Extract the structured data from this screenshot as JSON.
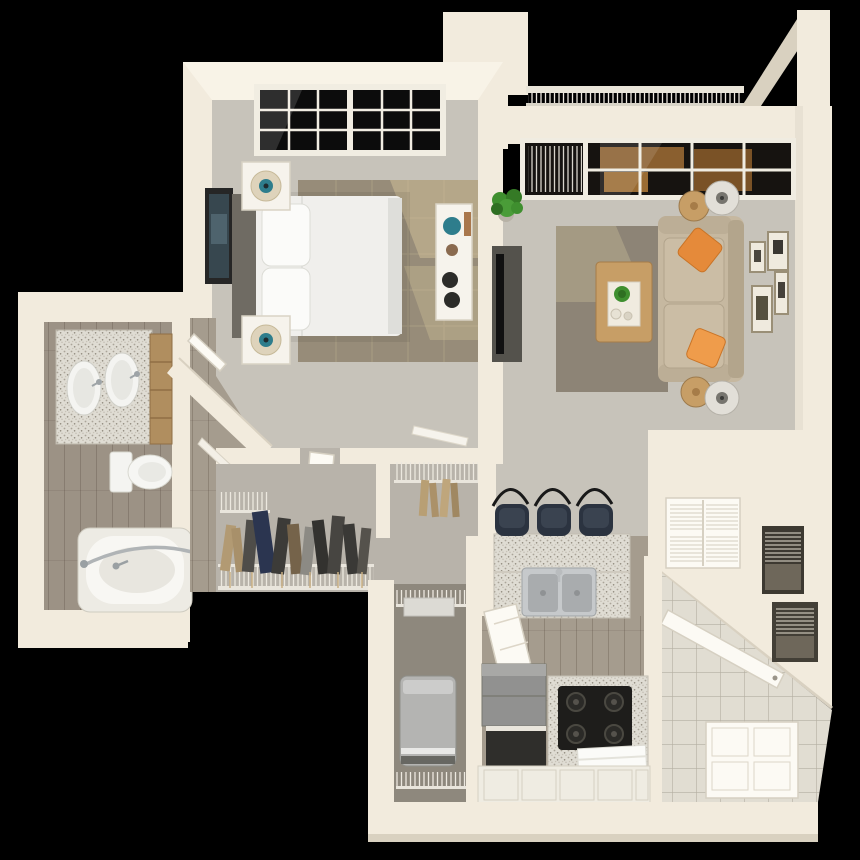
{
  "meta": {
    "type": "3d-floor-plan-render",
    "description": "Top-down 3D rendering of a one-bedroom, one-bathroom apartment floor plan with balcony, on a black background",
    "view": "isometric top-down dollhouse view",
    "visible_text": []
  },
  "palette": {
    "bg": "#000000",
    "wall": "#f2ebdd",
    "wallShade": "#d9d1c0",
    "wallBright": "#f8f3e7",
    "carpet": "#c7c3ba",
    "carpetDark": "#b8b3aa",
    "wood": "#a59c8e",
    "woodBath": "#9c9285",
    "tile": "#e1ddd2",
    "granite": "#dfdcd3",
    "rugBed": "#978c79",
    "rugLiving": "#8d8476",
    "sofa": "#c6b8a0",
    "orange": "#e58a3a",
    "teal": "#2e7d8c",
    "bedWhite": "#f0efec",
    "headboard": "#6f6b63",
    "tv": "#54524c",
    "appliance": "#b4b4b2",
    "cooktop": "#1e1d1b",
    "stool": "#2b3340",
    "plant": "#3f8f2f",
    "woodFurn": "#c79e66",
    "glass": "#0c0c0c"
  },
  "rooms": {
    "balcony": {
      "label": "Balcony with railing",
      "features": [
        "baluster railing",
        "patio furniture visible through windows"
      ]
    },
    "bedroom": {
      "label": "Bedroom",
      "features": [
        "double window",
        "queen bed with white bedding",
        "gray headboard",
        "two white nightstands with lamps",
        "taupe area rug",
        "white dresser with teal vase",
        "framed wall art",
        "gray carpet"
      ]
    },
    "living": {
      "label": "Living room",
      "features": [
        "window wall with sliding glass door",
        "beige sofa with two orange accent pillows",
        "light wood coffee table with plant",
        "taupe rug",
        "TV console with television",
        "two round side tables",
        "two drum floor lamps",
        "potted plant",
        "gallery wall of four frames"
      ]
    },
    "bathroom": {
      "label": "Bathroom",
      "features": [
        "granite double-sink vanity",
        "wood cabinets",
        "toilet",
        "bathtub with curved shower rod",
        "wood-look floor"
      ]
    },
    "closet": {
      "label": "Walk-in closet",
      "features": [
        "wire shelving",
        "hanging clothes",
        "open door"
      ]
    },
    "laundry": {
      "label": "Laundry closet",
      "features": [
        "washer/dryer",
        "wire shelves"
      ]
    },
    "kitchen": {
      "label": "Kitchen",
      "features": [
        "granite breakfast bar",
        "three dark bar stools",
        "double stainless sink",
        "refrigerator",
        "dishwasher",
        "gas range with towel",
        "white cabinets",
        "open door"
      ]
    },
    "entry": {
      "label": "Entry hall",
      "features": [
        "tile floor",
        "louvered closet doors",
        "linen niches with blinds",
        "open doors"
      ]
    }
  }
}
